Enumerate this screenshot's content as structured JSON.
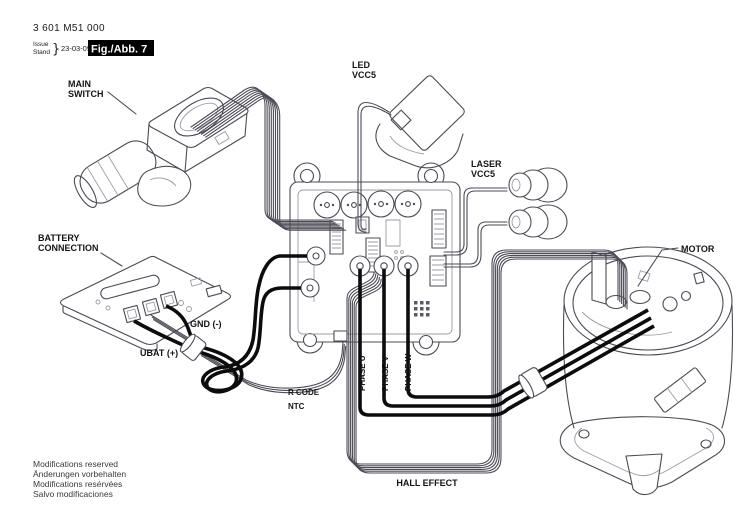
{
  "header": {
    "part_number": "3 601 M51 000",
    "issue_label": "Issue",
    "stand_label": "Stand",
    "brace": "}",
    "issue_date": "23-03-09",
    "figure_label": "Fig./Abb. 7"
  },
  "labels": {
    "main_switch": [
      "MAIN",
      "SWITCH"
    ],
    "led": [
      "LED",
      "VCC5"
    ],
    "laser": [
      "LASER",
      "VCC5"
    ],
    "battery": [
      "BATTERY",
      "CONNECTION"
    ],
    "gnd": "GND (-)",
    "ubat": "UBAT (+)",
    "r_code": "R CODE",
    "ntc": "NTC",
    "phase_u": "PHASE U",
    "phase_v": "PHASE V",
    "phase_w": "PHASE W",
    "hall_effect": "HALL EFFECT",
    "motor": "MOTOR"
  },
  "footer": {
    "lines": [
      "Modifications reserved",
      "Änderungen vorbehalten",
      "Modifications resérvées",
      "Salvo modificaciones"
    ]
  },
  "colors": {
    "background": "#ffffff",
    "outline": "#4b4b57",
    "wire": "#0c0c0c",
    "badge_bg": "#000000",
    "badge_fg": "#ffffff"
  }
}
